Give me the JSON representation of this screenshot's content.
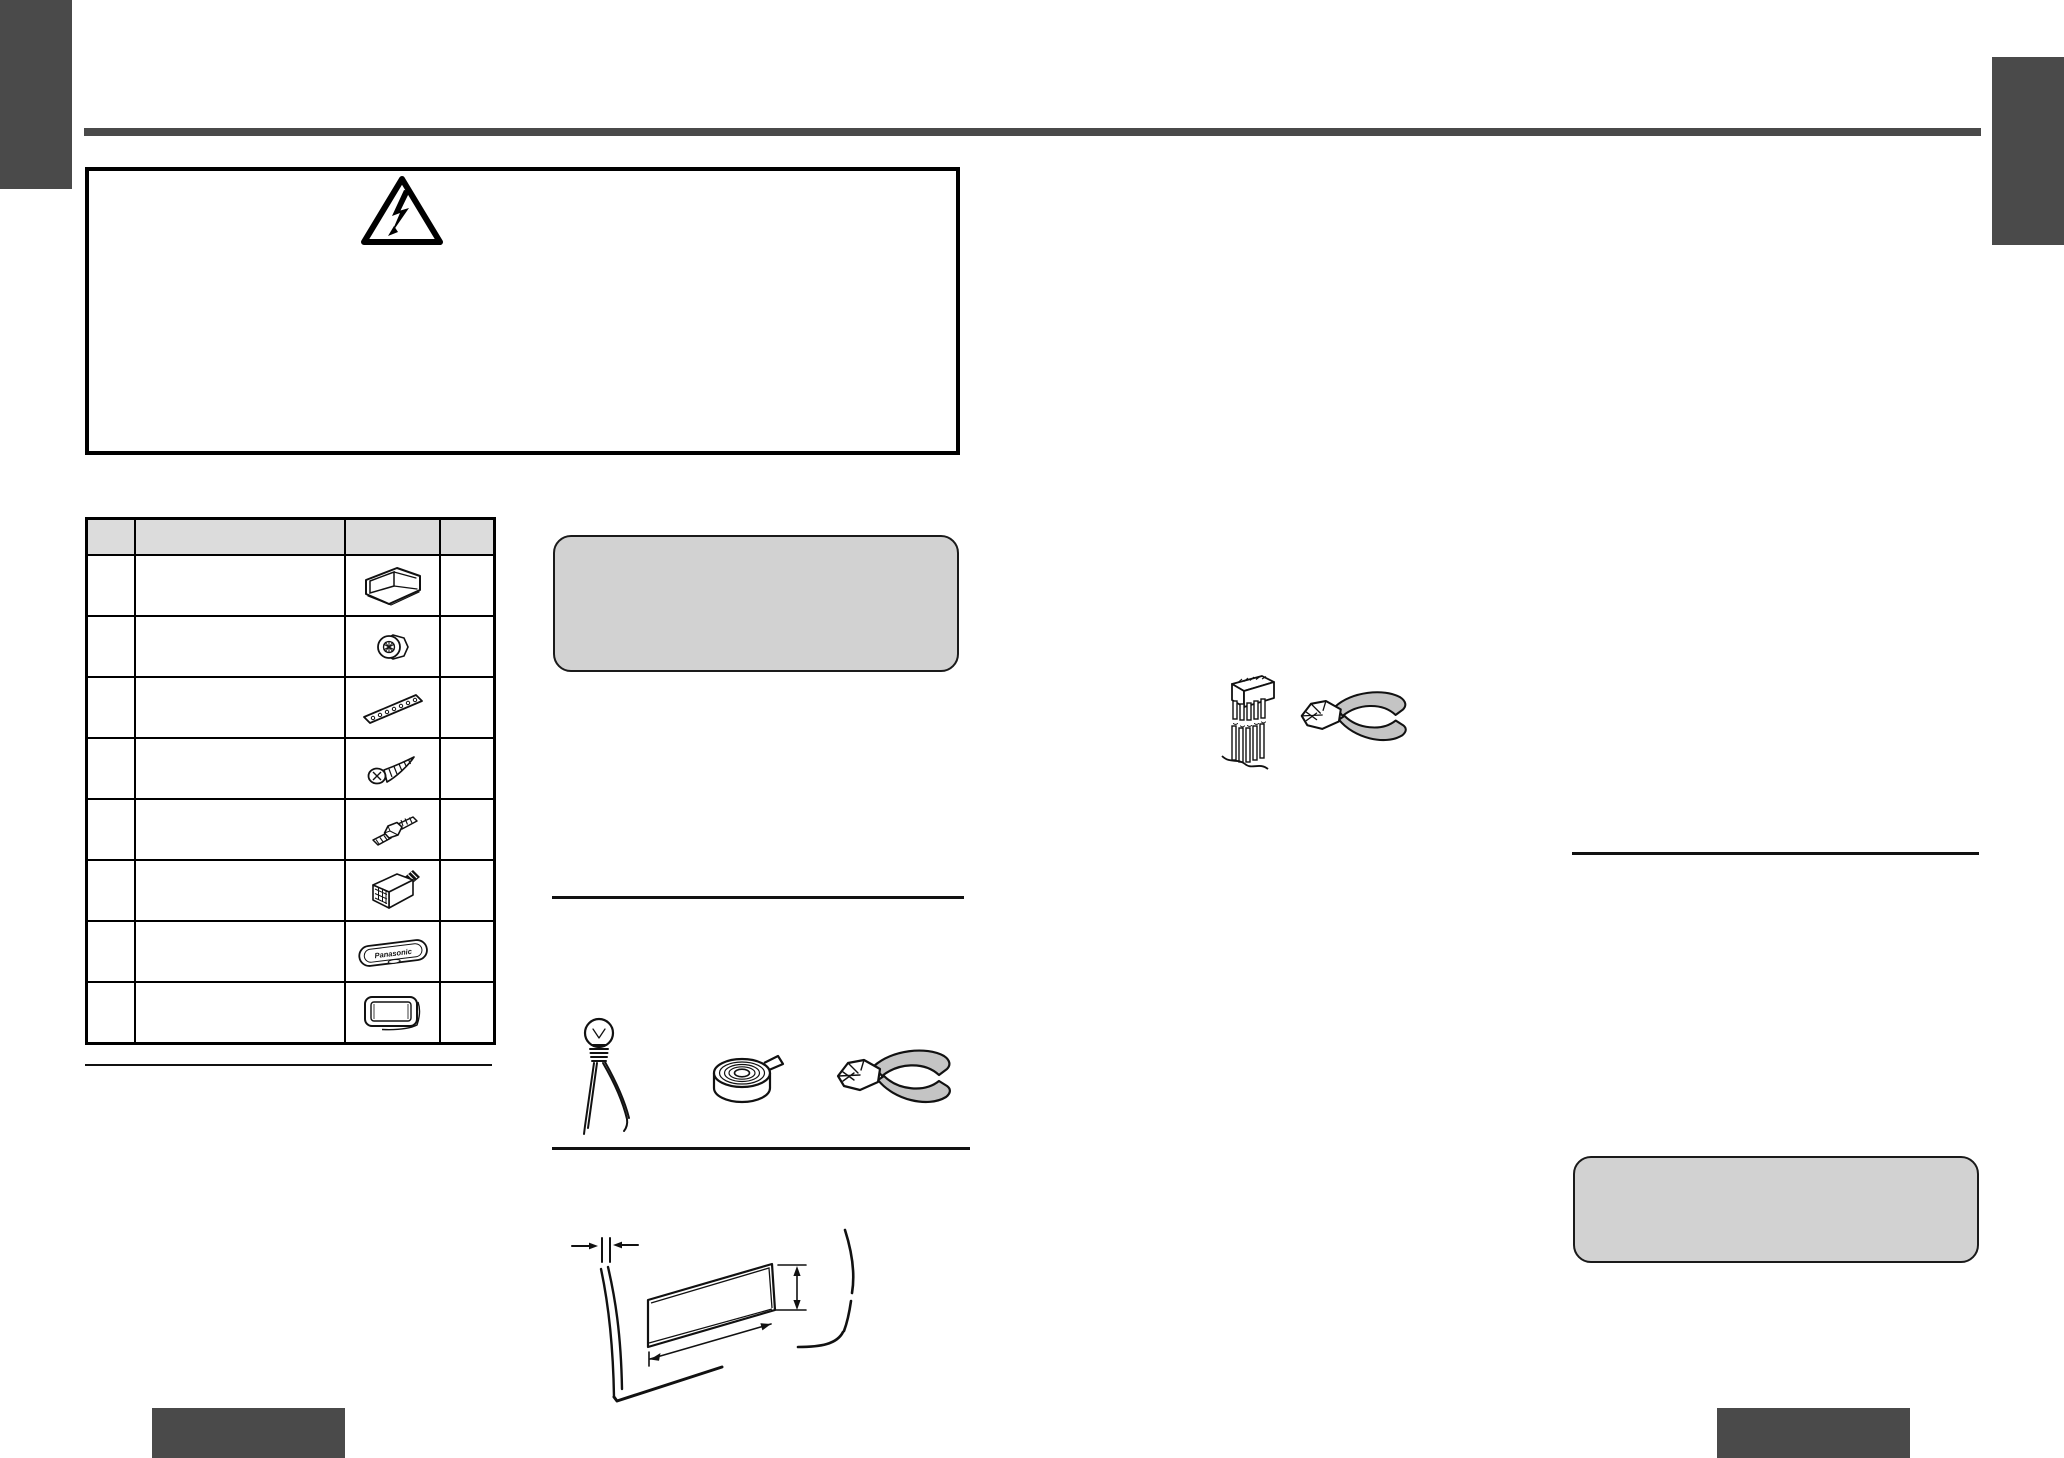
{
  "document": {
    "kind": "installation-manual-page"
  },
  "colors": {
    "page_bg": "#ffffff",
    "edge_tab_dark": "#4a4a4a",
    "title_rule_dark": "#4a4a4a",
    "thin_rule": "#111111",
    "note_panel_fill": "#d2d2d2",
    "note_panel_border": "#1a1a1a",
    "table_header_fill": "#dcdcdc",
    "line_art": "#111111",
    "tool_handle_fill": "#c4c4c4"
  },
  "chrome": {
    "left_edge_tab_label": "",
    "right_edge_tab_label": "",
    "bottom_left_tab_label": "",
    "bottom_right_tab_label": ""
  },
  "warning_panel": {
    "icon": "high-voltage-triangle-icon",
    "body_text": ""
  },
  "parts_table": {
    "columns": [
      "",
      "",
      "",
      ""
    ],
    "rows": [
      {
        "illustration": "mounting-collar-icon",
        "label": "",
        "qty": ""
      },
      {
        "illustration": "hex-nut-icon",
        "label": "",
        "qty": ""
      },
      {
        "illustration": "mounting-strap-icon",
        "label": "",
        "qty": ""
      },
      {
        "illustration": "tapping-screw-icon",
        "label": "",
        "qty": ""
      },
      {
        "illustration": "mounting-bolt-icon",
        "label": "",
        "qty": ""
      },
      {
        "illustration": "power-connector-icon",
        "label": "",
        "qty": ""
      },
      {
        "illustration": "remote-control-icon",
        "label": "",
        "qty": "",
        "brand_text": "Panasonic"
      },
      {
        "illustration": "trim-frame-icon",
        "label": "",
        "qty": ""
      }
    ]
  },
  "note_panel_top": {
    "body_text": ""
  },
  "tools_figure": {
    "icons": [
      "test-lamp-icon",
      "insulating-tape-icon",
      "side-cutters-icon"
    ]
  },
  "wire_cut_figure": {
    "icons": [
      "cut-connector-icon",
      "side-cutters-icon"
    ]
  },
  "dashboard_figure": {
    "icon": "dashboard-opening-diagram",
    "annotations": [
      "thickness-dimension",
      "width-dimension",
      "height-dimension"
    ]
  },
  "note_panel_bottom": {
    "body_text": ""
  }
}
